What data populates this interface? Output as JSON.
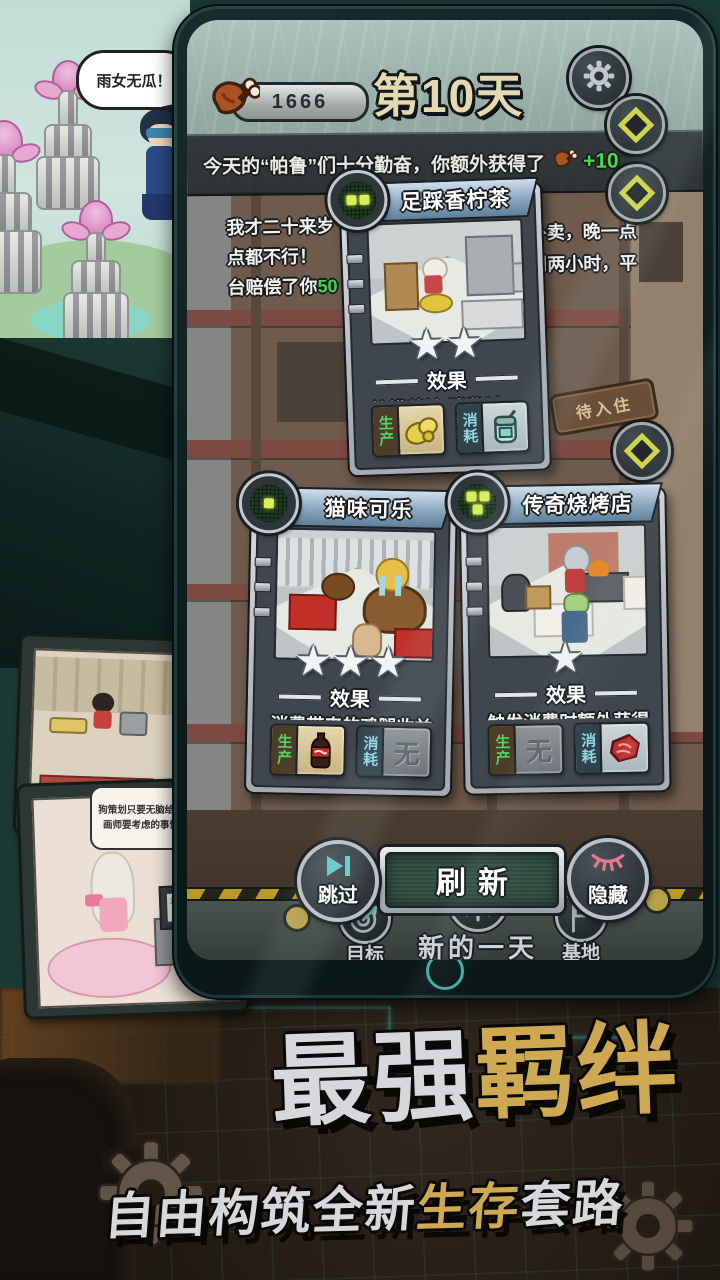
{
  "scene": {
    "bubble_top": "雨女无瓜！",
    "tv_bubble_line1": "狗策划只要无脑给需求就行了",
    "tv_bubble_line2": "画师要考虑的事情就很多了",
    "monitor_text": "五彩斑斓的黑"
  },
  "promo": {
    "title_part1": "最强",
    "title_part2": "羁绊",
    "subtitle_part1": "自由构筑",
    "subtitle_part2": "全新",
    "subtitle_part3": "生存",
    "subtitle_part4": "套路"
  },
  "game": {
    "hud": {
      "meat_count": "1666",
      "day": "第10天",
      "banner": "今天的“帕鲁”们十分勤奋，你额外获得了",
      "bonus": "+10"
    },
    "dialog": {
      "left_1": "我才二十来岁",
      "left_2": "点都不行！",
      "left_3": "台赔偿了你",
      "left_3_hl": "50",
      "right_1": "外卖，晚一点",
      "right_2": "到两小时，平"
    },
    "sign_vacant": "待入住",
    "cards": [
      {
        "title": "足踩香柠茶",
        "dots": 2,
        "stars": 2,
        "effect_header": "效果",
        "effect": {
          "pre": "柠檬茶被 消费时，有",
          "hl": "50%",
          "post": "概率再次产出一杯柠檬茶"
        },
        "produce": {
          "label": "生产"
        },
        "consume": {
          "label": "消耗"
        }
      },
      {
        "title": "猫味可乐",
        "dots": 1,
        "stars": 3,
        "effect_header": "效果",
        "effect": {
          "pre": "消费带来的鸡腿收益",
          "hl": "+100%",
          "post": "，但相邻的角色不再每日被动获取鸡腿"
        },
        "produce": {
          "label": "生产"
        },
        "consume": {
          "label": "消耗",
          "none": "无"
        }
      },
      {
        "title": "传奇烧烤店",
        "dots": 3,
        "stars": 1,
        "effect_header": "效果",
        "effect": {
          "pre": "触发消费时额外获得",
          "hl": "10个",
          "post": "且每有一家",
          "post2": "相同单位额外获得的",
          "post3": "数量提升1…"
        },
        "produce": {
          "label": "生产",
          "none": "无"
        },
        "consume": {
          "label": "消耗"
        }
      }
    ],
    "buttons": {
      "skip": "跳过",
      "refresh": "刷新",
      "hide": "隐藏"
    },
    "nav": {
      "goal": "目标",
      "new_day": "新的一天",
      "base": "基地",
      "badge": "下班"
    }
  }
}
